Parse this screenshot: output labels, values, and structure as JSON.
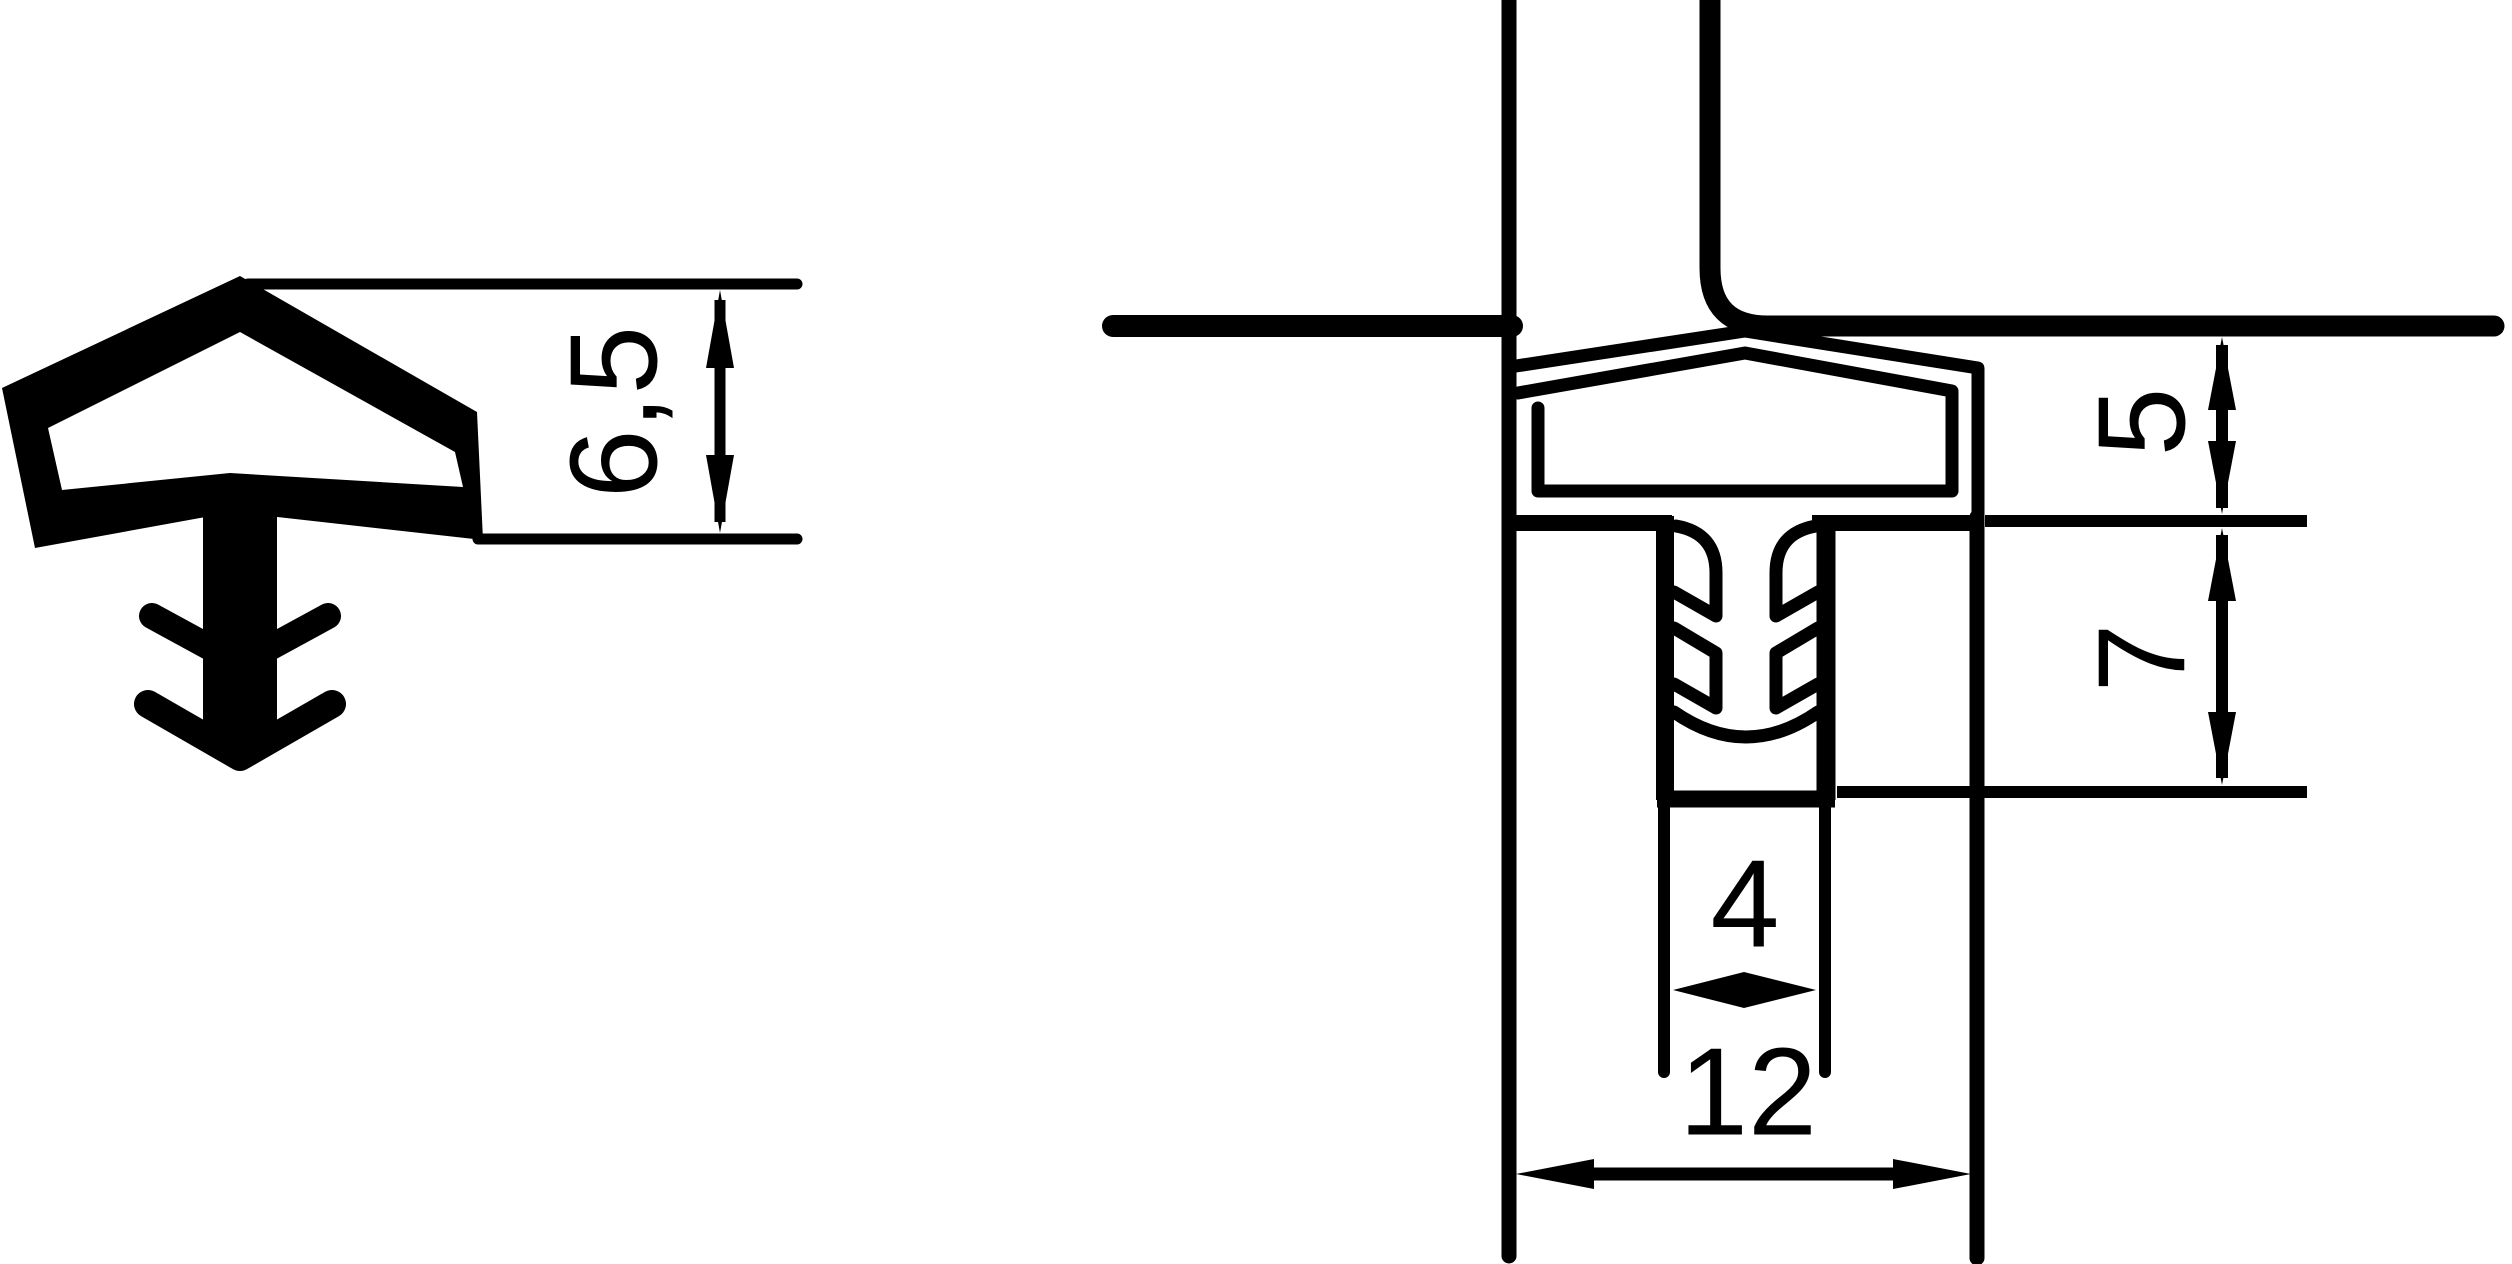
{
  "drawing": {
    "background_color": "#ffffff",
    "ink_color": "#000000",
    "views": {
      "left": {
        "name": "seal-profile-cross-section"
      },
      "right": {
        "name": "seal-installed-in-frame-groove"
      }
    },
    "dimensions": {
      "profile_height": {
        "value": "6,5"
      },
      "reveal_depth": {
        "value": "5"
      },
      "groove_depth": {
        "value": "7"
      },
      "groove_width": {
        "value": "4"
      },
      "overall_width": {
        "value": "12"
      }
    }
  }
}
